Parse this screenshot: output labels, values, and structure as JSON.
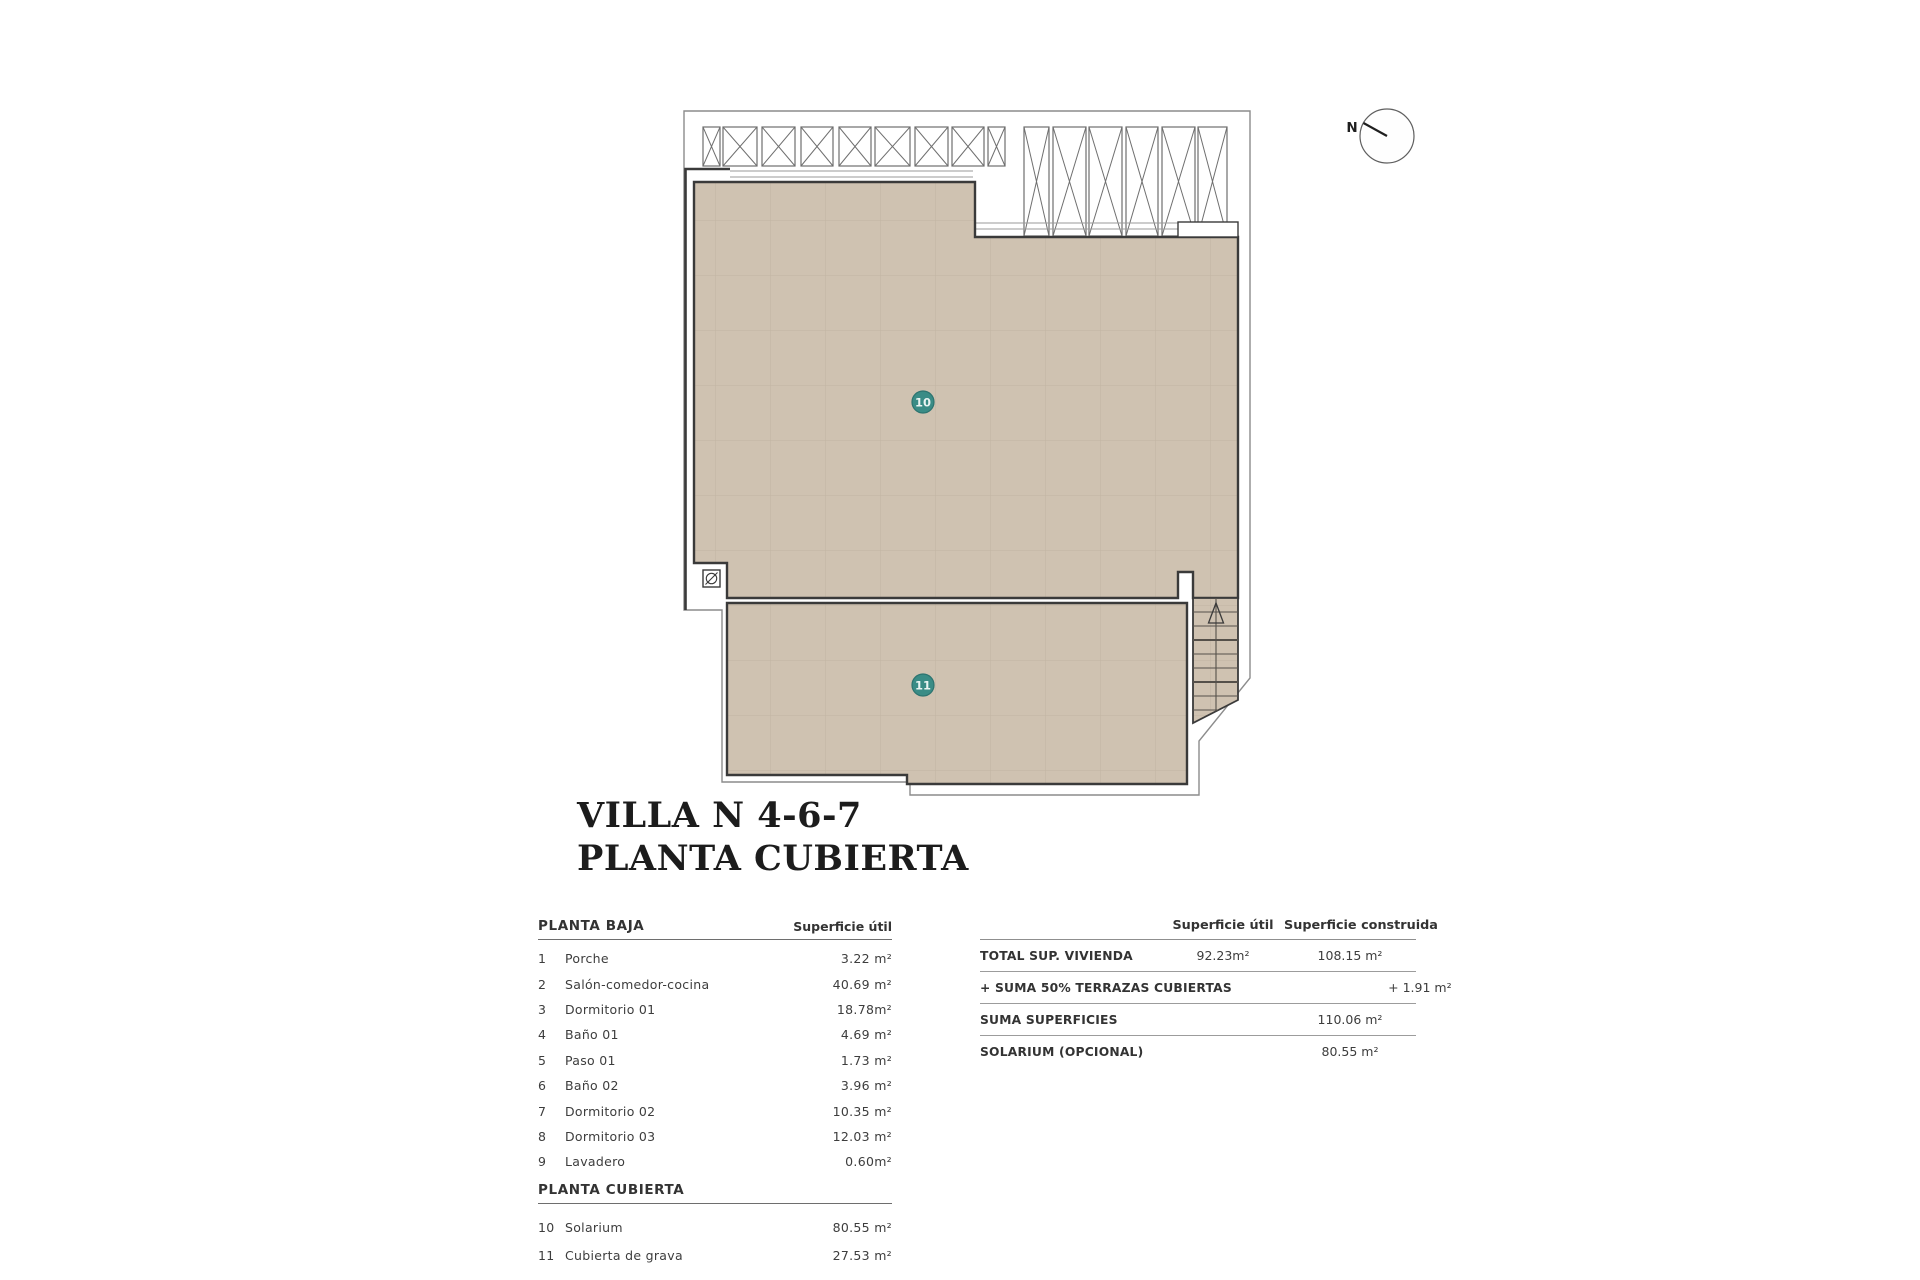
{
  "title": {
    "line1": "VILLA N 4-6-7",
    "line2": "PLANTA CUBIERTA"
  },
  "plan": {
    "north_label": "N",
    "label10": "10",
    "label11": "11"
  },
  "rooms_table": {
    "section1_header": "PLANTA BAJA",
    "col_header": "Superficie útil",
    "section1_rows": [
      {
        "num": "1",
        "name": "Porche",
        "area": "3.22 m²"
      },
      {
        "num": "2",
        "name": "Salón-comedor-cocina",
        "area": "40.69 m²"
      },
      {
        "num": "3",
        "name": "Dormitorio 01",
        "area": "18.78m²"
      },
      {
        "num": "4",
        "name": "Baño 01",
        "area": "4.69 m²"
      },
      {
        "num": "5",
        "name": "Paso 01",
        "area": "1.73 m²"
      },
      {
        "num": "6",
        "name": "Baño 02",
        "area": "3.96 m²"
      },
      {
        "num": "7",
        "name": "Dormitorio 02",
        "area": "10.35 m²"
      },
      {
        "num": "8",
        "name": "Dormitorio 03",
        "area": "12.03 m²"
      },
      {
        "num": "9",
        "name": "Lavadero",
        "area": "0.60m²"
      }
    ],
    "section2_header": "PLANTA CUBIERTA",
    "section2_rows": [
      {
        "num": "10",
        "name": "Solarium",
        "area": "80.55 m²"
      },
      {
        "num": "11",
        "name": "Cubierta de grava",
        "area": "27.53 m²"
      }
    ]
  },
  "summary_table": {
    "col_header_util": "Superficie útil",
    "col_header_construida": "Superficie construida",
    "rows": [
      {
        "label": "TOTAL SUP. VIVIENDA",
        "util": "92.23m²",
        "construida": "108.15 m²"
      },
      {
        "label": "+ SUMA 50% TERRAZAS CUBIERTAS",
        "util": "",
        "construida": "+ 1.91 m²"
      },
      {
        "label": "SUMA SUPERFICIES",
        "util": "",
        "construida": "110.06 m²"
      },
      {
        "label": "SOLARIUM (OPCIONAL)",
        "util": "",
        "construida": "80.55 m²"
      }
    ]
  },
  "colors": {
    "roof_fill": "#cfc2b1",
    "roof_grid": "#c2b4a2",
    "outline_thick": "#3a3a3a",
    "outline_thin": "#8c8c8c",
    "pergola_stroke": "#6f6f6f",
    "teal_badge": "#3a8c86",
    "teal_badge_ring": "#2d7470",
    "text": "#3d3d3d",
    "title_text": "#1c1c1c"
  }
}
